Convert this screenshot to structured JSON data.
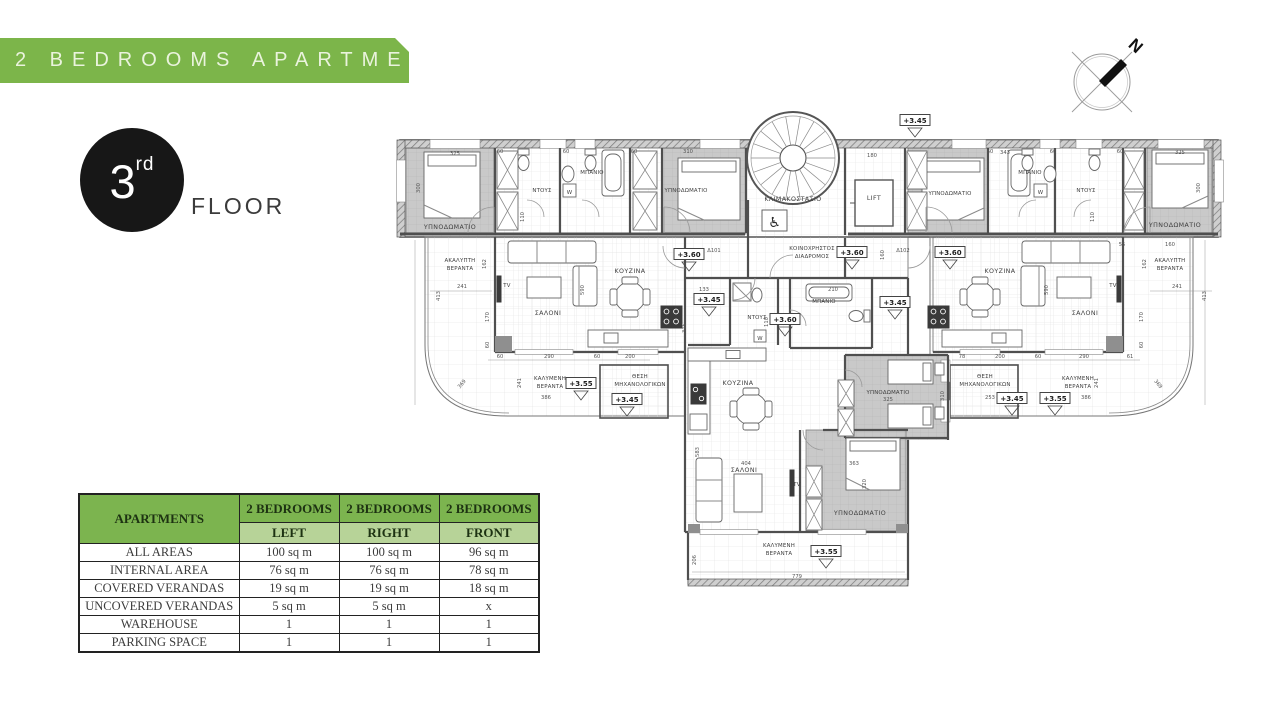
{
  "banner": {
    "title": "2 BEDROOMS APARTMENTS",
    "bg_color": "#7cb54a"
  },
  "floor_badge": {
    "number": "3",
    "ordinal": "rd",
    "label": "FLOOR"
  },
  "compass": {
    "north_label": "N"
  },
  "plan": {
    "rooms": {
      "bedroom": "ΥΠΝΟΔΩΜΑΤΙΟ",
      "shower": "ΝΤΟΥΣ",
      "bathroom": "ΜΠΑΝΙΟ",
      "kitchen": "ΚΟΥΖΙΝΑ",
      "living_room": "ΣΑΛΟΝΙ",
      "stairwell": "ΚΛΙΜΑΚΟΣΤΑΣΙΟ",
      "lift": "LIFT",
      "corridor_line1": "ΚΟΙΝΟΧΡΗΣΤΟΣ",
      "corridor_line2": "ΔΙΑΔΡΟΜΟΣ",
      "uncovered_veranda_line1": "ΑΚΑΛΥΠΤΗ",
      "uncovered_veranda_line2": "ΒΕΡΑΝΤΑ",
      "covered_veranda_line1": "ΚΑΛΥΜΕΝΗ",
      "covered_veranda_line2": "ΒΕΡΑΝΤΑ",
      "mech_line1": "ΘΕΣΗ",
      "mech_line2": "ΜΗΧΑΝΟΛΟΓΙΚΩΝ",
      "tv": "TV",
      "washer": "W",
      "accessible": "♿"
    },
    "elevations": {
      "e345": "+3.45",
      "e355": "+3.55",
      "e360": "+3.60"
    },
    "dims": {
      "d55": "55",
      "d60": "60",
      "d61": "61",
      "d78": "78",
      "d110": "110",
      "d133": "133",
      "d160": "160",
      "d162": "162",
      "d170": "170",
      "d180": "180",
      "d200": "200",
      "d206": "206",
      "d210": "210",
      "d241": "241",
      "d253": "253",
      "d290": "290",
      "d300": "300",
      "d310": "310",
      "d315": "315",
      "d320": "320",
      "d325": "325",
      "d343": "343",
      "d363": "363",
      "d369": "369",
      "d386": "386",
      "d404": "404",
      "d413": "413",
      "d583": "583",
      "d590": "590",
      "d779": "779",
      "door101": "Δ101",
      "door102": "Δ102"
    }
  },
  "table": {
    "corner_header": "APARTMENTS",
    "col_headers": [
      "2 BEDROOMS",
      "2 BEDROOMS",
      "2 BEDROOMS"
    ],
    "sub_headers": [
      "LEFT",
      "RIGHT",
      "FRONT"
    ],
    "rows": [
      {
        "label": "ALL AREAS",
        "values": [
          "100 sq m",
          "100 sq m",
          "96 sq m"
        ]
      },
      {
        "label": "INTERNAL AREA",
        "values": [
          "76 sq m",
          "76 sq m",
          "78 sq m"
        ]
      },
      {
        "label": "COVERED VERANDAS",
        "values": [
          "19 sq m",
          "19 sq m",
          "18 sq m"
        ]
      },
      {
        "label": "UNCOVERED VERANDAS",
        "values": [
          "5 sq m",
          "5 sq m",
          "x"
        ]
      },
      {
        "label": "WAREHOUSE",
        "values": [
          "1",
          "1",
          "1"
        ]
      },
      {
        "label": "PARKING SPACE",
        "values": [
          "1",
          "1",
          "1"
        ]
      }
    ],
    "header_green": "#7cb44f",
    "subheader_green": "#b7d398"
  }
}
